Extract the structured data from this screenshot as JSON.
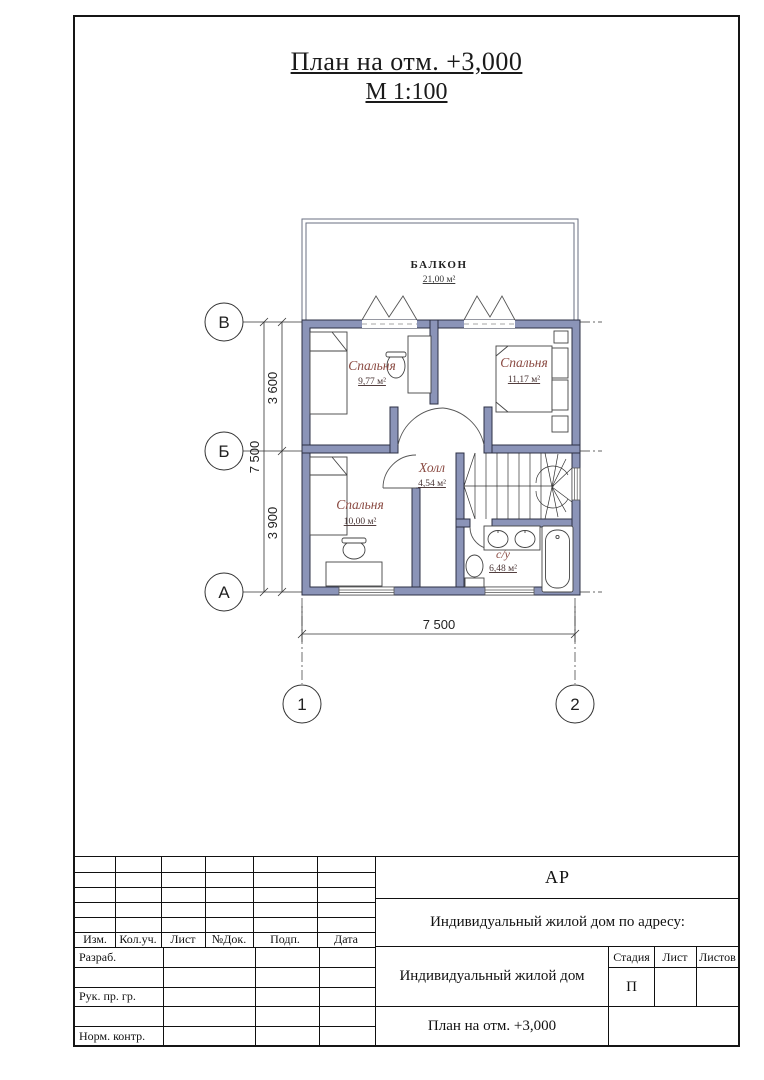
{
  "title": {
    "line1": "План на отм. +3,000",
    "line2": "М 1:100"
  },
  "plan": {
    "balcony_name": "БАЛКОН",
    "balcony_area": "21,00 м²",
    "room_ul_name": "Спальня",
    "room_ul_area": "9,77 м²",
    "room_ur_name": "Спальня",
    "room_ur_area": "11,17 м²",
    "hall_name": "Холл",
    "hall_area": "4,54 м²",
    "room_ll_name": "Спальня",
    "room_ll_area": "10,00 м²",
    "bath_name": "с/у",
    "bath_area": "6,48 м²",
    "axes": {
      "row_top": "В",
      "row_mid": "Б",
      "row_bottom": "А",
      "col_left": "1",
      "col_right": "2"
    },
    "dims": {
      "v_total": "7 500",
      "v_top": "3 600",
      "v_bottom": "3 900",
      "h_total": "7 500"
    },
    "colors": {
      "wall_fill": "#8b94b8",
      "room_label": "#8a4a42"
    }
  },
  "title_block": {
    "code": "АР",
    "address": "Индивидуальный жилой дом по адресу:",
    "col_izm": "Изм.",
    "col_koluch": "Кол.уч.",
    "col_list": "Лист",
    "col_doc": "№Док.",
    "col_podp": "Подп.",
    "col_data": "Дата",
    "row_razrab": "Разраб.",
    "row_ruk": "Рук. пр. гр.",
    "row_norm": "Норм. контр.",
    "project": "Индивидуальный жилой дом",
    "drawing": "План на отм. +3,000",
    "stage_label": "Стадия",
    "list_label": "Лист",
    "listov_label": "Листов",
    "stage_value": "П"
  }
}
